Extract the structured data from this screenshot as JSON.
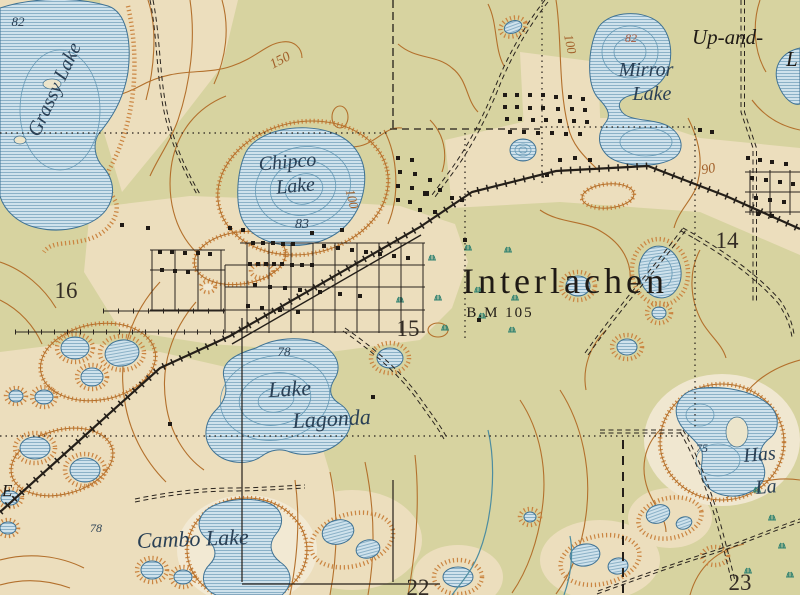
{
  "map": {
    "place_labels": {
      "grassy_lake": "Grassy Lake",
      "grassy_elev": "82",
      "chipco_1": "Chipco",
      "chipco_2": "Lake",
      "chipco_elev": "83",
      "mirror_1": "Mirror",
      "mirror_2": "Lake",
      "mirror_elev": "82",
      "up_and": "Up-and-",
      "up_and_cut": "L",
      "interlachen": "Interlachen",
      "benchmark": "B.M 105",
      "lagonda_1": "Lake",
      "lagonda_2": "Lagonda",
      "lagonda_elev": "78",
      "cambo": "Cambo Lake",
      "cambo_elev": "78",
      "hastings_1": "Has",
      "hastings_2": "La",
      "hastings_elev": "75",
      "edge_word": "E"
    },
    "contour_labels": {
      "c150": "150",
      "c100_chipco": "100",
      "c100_mirror": "100",
      "c90": "90"
    },
    "section_numbers": {
      "s16": "16",
      "s15": "15",
      "s14": "14",
      "s22": "22",
      "s23": "23"
    },
    "water_features": [
      "Grassy Lake",
      "Chipco Lake",
      "Mirror Lake",
      "Lake Lagonda",
      "Cambo Lake"
    ],
    "spot_elevations": [
      "82",
      "83",
      "82",
      "78",
      "78",
      "75",
      "B.M 105"
    ],
    "colors": {
      "land_green": "#d7d3a0",
      "cleared_tan": "#ecdebd",
      "pale_halo": "#f2e9d3",
      "water_fill": "#cfe2ec",
      "water_line": "#3f7294",
      "contour_brown": "#b3702c",
      "hachure_orange": "#ca8440",
      "culture_black": "#241f19",
      "marsh_teal": "#2e8070"
    }
  }
}
